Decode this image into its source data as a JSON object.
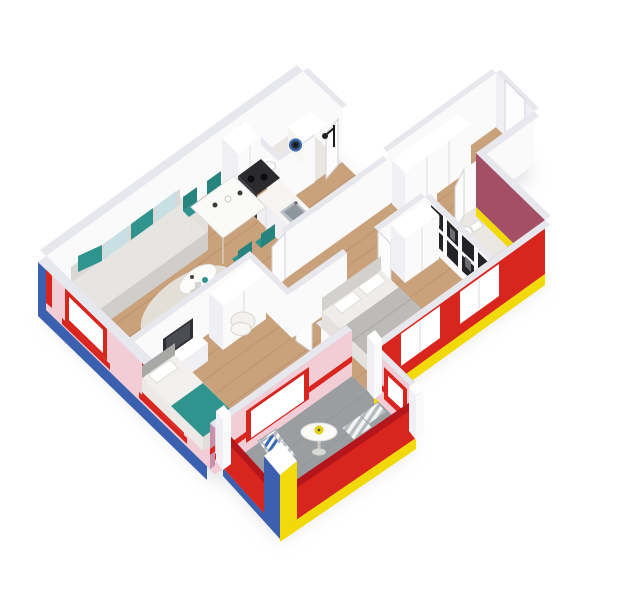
{
  "scene": {
    "title": "3D isometric cutaway floor plan render of a two-bedroom apartment with balcony",
    "view": "aerial isometric from the south-east, walls cut at mid height",
    "background": "#ffffff",
    "visible_text": "none"
  },
  "palette": {
    "background": "#ffffff",
    "wall_white": "#fafafb",
    "wall_shadow": "#e7e7ee",
    "wall_pink": "#f3cdd6",
    "wall_mauve": "#c493ab",
    "facade_blue": "#3c60b0",
    "facade_red": "#d8251d",
    "facade_dark_red": "#b5161b",
    "facade_maroon": "#a34f66",
    "trim_yellow": "#f2da0a",
    "floor_wood": "#c9a27c",
    "floor_wood_dark": "#a87f5c",
    "floor_gray": "#9b9ea1",
    "floor_bath": "#eae6e1",
    "sofa_gray": "#d9d8d4",
    "teal": "#2f948e",
    "light_blue": "#c8e0e3",
    "bed_gray": "#bdbbb7",
    "black": "#212124",
    "machine_blue": "#3f6db3"
  },
  "facade": {
    "style": "Mondrian-like primary colours on exterior walls",
    "north_west_wall": "white",
    "south_west_wall": "blue outside, pink inside, red window frames and sills",
    "south_east_wall": "red with white windows and yellow base trim",
    "east_wall": "maroon with yellow base trim",
    "balcony_parapet": "red with yellow and blue base trim",
    "corner_pillar": "blue and yellow faces with white cap",
    "window_count": 6
  },
  "rooms": [
    {
      "name": "living-dining-kitchen",
      "floor": "wood",
      "furniture": [
        "gray sofa with teal and light-blue cushions",
        "oval white coffee table",
        "light area rug",
        "white dining table",
        "four teal dining chairs",
        "tall fridge cabinet",
        "black stove and oven",
        "kitchen counter with sink"
      ]
    },
    {
      "name": "laundry-bathroom",
      "floor": "stone",
      "furniture": [
        "washing machine with blue porthole",
        "toilet",
        "black shower fitting"
      ]
    },
    {
      "name": "entrance-corridor",
      "floor": "wood",
      "furniture": [
        "entrance door",
        "built-in closets"
      ]
    },
    {
      "name": "hallway",
      "floor": "wood",
      "furniture": [
        "open interior doors"
      ]
    },
    {
      "name": "bathroom",
      "floor": "stone",
      "furniture": [
        "toilet",
        "pedestal washbasin",
        "black articulated shower column"
      ]
    },
    {
      "name": "bedroom",
      "floor": "wood",
      "furniture": [
        "double bed with gray duvet",
        "white pillows",
        "gallery wall of black picture frames",
        "white wardrobe"
      ]
    },
    {
      "name": "kids-room",
      "floor": "wood",
      "furniture": [
        "single bed with teal blanket",
        "TV sideboard with dark TV",
        "white wardrobe",
        "white armchair"
      ]
    },
    {
      "name": "balcony",
      "floor": "gray concrete",
      "furniture": [
        "round bistro table with yellow plate",
        "two gray-striped loungers",
        "blue striped towel"
      ]
    }
  ]
}
